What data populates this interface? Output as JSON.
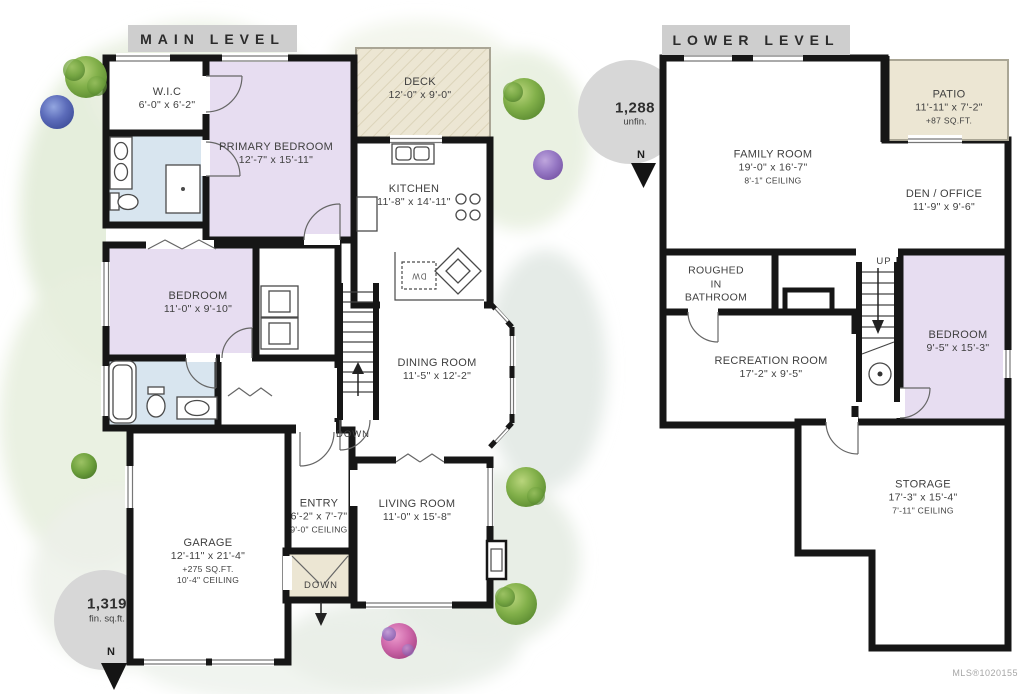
{
  "main_level": {
    "title": "MAIN LEVEL",
    "badge": {
      "value": "1,319",
      "caption": "fin. sq.ft.",
      "north": "N"
    },
    "stairs_label": "DOWN",
    "landing_label": "DOWN",
    "rooms": {
      "wic": {
        "name": "W.I.C",
        "dims": "6'-0\" x 6'-2\""
      },
      "primary_bedroom": {
        "name": "PRIMARY BEDROOM",
        "dims": "12'-7\" x 15'-11\""
      },
      "deck": {
        "name": "DECK",
        "dims": "12'-0\" x 9'-0\""
      },
      "kitchen": {
        "name": "KITCHEN",
        "dims": "11'-8\" x 14'-11\""
      },
      "bedroom": {
        "name": "BEDROOM",
        "dims": "11'-0\" x 9'-10\""
      },
      "dining_room": {
        "name": "DINING ROOM",
        "dims": "11'-5\" x 12'-2\""
      },
      "entry": {
        "name": "ENTRY",
        "dims": "6'-2\" x 7'-7\"",
        "ceiling": "9'-0\" CEILING"
      },
      "living_room": {
        "name": "LIVING ROOM",
        "dims": "11'-0\" x 15'-8\""
      },
      "garage": {
        "name": "GARAGE",
        "dims": "12'-11\" x 21'-4\"",
        "area": "+275 SQ.FT.",
        "ceiling": "10'-4\" CEILING"
      }
    },
    "appliances": {
      "dishwasher": "DW"
    }
  },
  "lower_level": {
    "title": "LOWER LEVEL",
    "badge": {
      "value": "1,288",
      "caption": "unfin.",
      "north": "N"
    },
    "stairs_label": "UP",
    "rooms": {
      "family_room": {
        "name": "FAMILY ROOM",
        "dims": "19'-0\" x 16'-7\"",
        "ceiling": "8'-1\" CEILING"
      },
      "patio": {
        "name": "PATIO",
        "dims": "11'-11\" x 7'-2\"",
        "area": "+87 SQ.FT."
      },
      "den_office": {
        "name": "DEN / OFFICE",
        "dims": "11'-9\" x 9'-6\""
      },
      "roughed_in_bathroom": {
        "line1": "ROUGHED",
        "line2": "IN",
        "line3": "BATHROOM"
      },
      "recreation_room": {
        "name": "RECREATION ROOM",
        "dims": "17'-2\" x 9'-5\""
      },
      "bedroom": {
        "name": "BEDROOM",
        "dims": "9'-5\" x 15'-3\""
      },
      "storage": {
        "name": "STORAGE",
        "dims": "17'-3\" x 15'-4\"",
        "ceiling": "7'-11\" CEILING"
      }
    }
  },
  "footer": {
    "mls": "MLS®1020155"
  },
  "colors": {
    "wall": "#161616",
    "bedroom_fill": "#e7ddf1",
    "bath_fill": "#d8e5ef",
    "outdoor_fill": "#ece6d3",
    "banner_bg": "#cecece",
    "badge_bg": "#d7d7d7"
  }
}
